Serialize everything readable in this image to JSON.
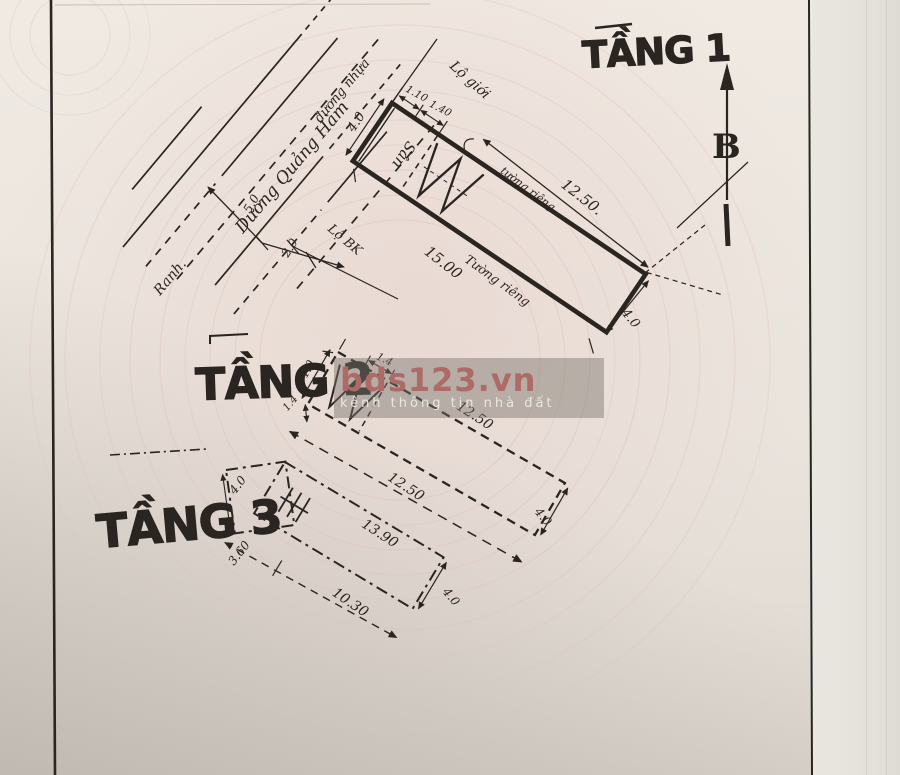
{
  "titles": {
    "floor1": "TẦNG 1",
    "floor2": "TẦNG 2",
    "floor3": "TẦNG 3"
  },
  "compass": {
    "north_label": "B"
  },
  "street": {
    "name": "Dương Quảng Hàm",
    "surface_label": "đường nhựa",
    "edge_label": "Ranh.",
    "dim_outer": "5.0",
    "dim_inner": "2.0",
    "boundary_top": "Lộ giới",
    "boundary_left": "Lộ BK"
  },
  "floor1": {
    "yard": "Sân",
    "dim_left": "4.0",
    "dim_top_a": "1.10",
    "dim_top_b": "1.40",
    "dim_front": "12.50.",
    "wall_top": "tường riêng",
    "wall_bottom": "Tường riêng",
    "dim_bottom": "15.00",
    "dim_right": "4.0"
  },
  "floor2": {
    "dim_top_small": "1.4",
    "dim_left": "4.0",
    "dim_side_small": "1.4",
    "dim_top": "12.50",
    "dim_bottom": "12.50",
    "dim_right": "4.0"
  },
  "floor3": {
    "dim_left": "4.0",
    "dim_setback": "3.60",
    "dim_top": "13.90",
    "dim_bottom": "10.30",
    "dim_right": "4.0"
  },
  "watermark": {
    "brand": "bds123.vn",
    "tagline": "kênh thông tin nhà đất",
    "brand_color": "#ad6a66",
    "tagline_color": "#e9e6e1",
    "band_color": "rgba(122,116,108,0.45)"
  },
  "colors": {
    "ink": "#2a2521",
    "paper": "#ece6df",
    "guilloche": "#e2c4bd"
  }
}
